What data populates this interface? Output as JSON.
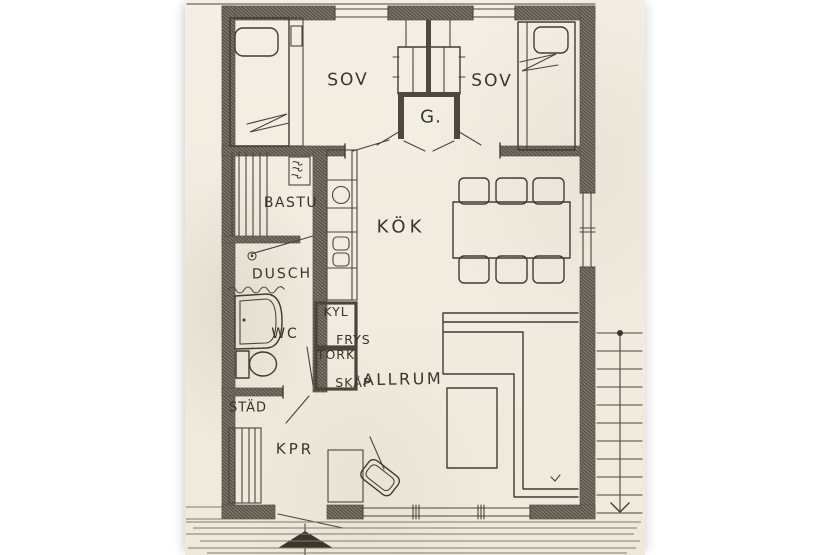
{
  "labels": {
    "bedroom_left": "SOV",
    "bedroom_right": "SOV",
    "closet": "G.",
    "kitchen": "KÖK",
    "sauna": "BASTU",
    "shower": "DUSCH",
    "wc": "WC",
    "fridge_line1": "KYL",
    "fridge_line2": "FRYS",
    "drying_line1": "TORK",
    "drying_line2": "SKÅP",
    "living_room": "ALLRUM",
    "cleaning": "STÄD",
    "hall": "KPR"
  },
  "colors": {
    "paper": "#f3efe4",
    "ink": "#413c33",
    "wall_hatch": "#6e6860",
    "margin": "#ffffff"
  }
}
